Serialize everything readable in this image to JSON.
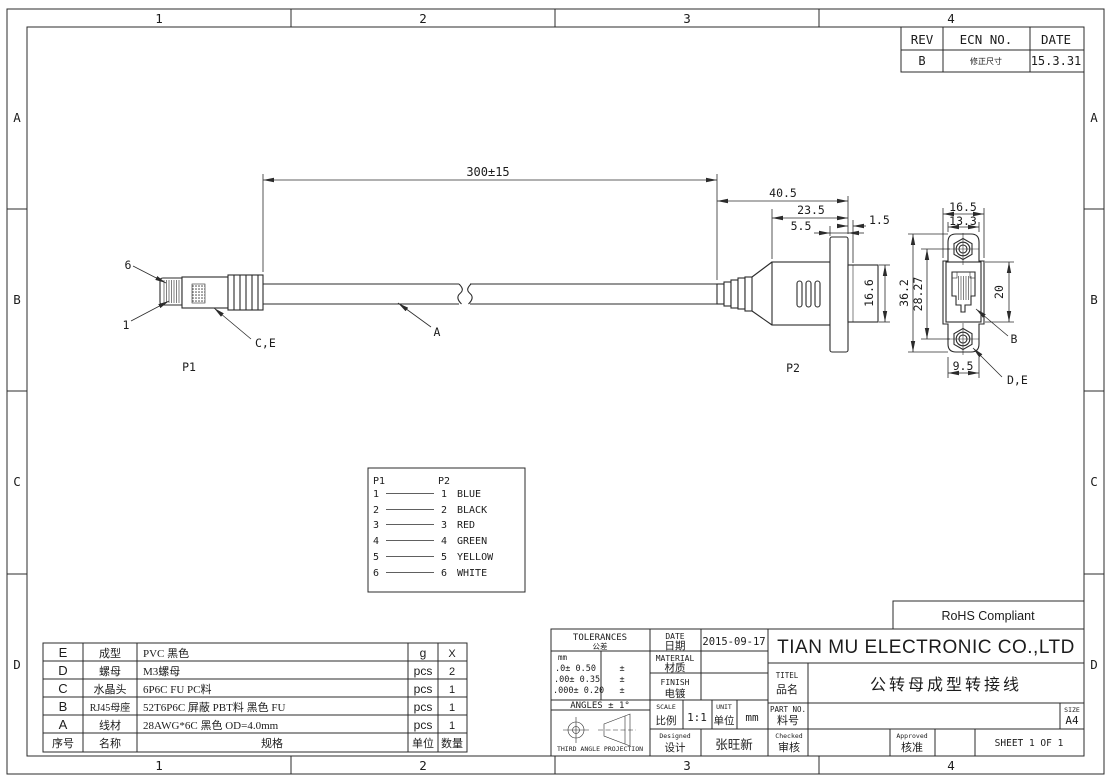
{
  "zones": {
    "cols": [
      "1",
      "2",
      "3",
      "4"
    ],
    "rows": [
      "A",
      "B",
      "C",
      "D"
    ]
  },
  "rev_table": {
    "headers": [
      "REV",
      "ECN NO.",
      "DATE"
    ],
    "row": {
      "rev": "B",
      "ecn": "修正尺寸",
      "date": "15.3.31"
    }
  },
  "drawing": {
    "p1_label": "P1",
    "p2_label": "P2",
    "pin_top": "6",
    "pin_bottom": "1",
    "ref_ce": "C,E",
    "ref_a": "A",
    "ref_b": "B",
    "ref_de": "D,E",
    "dims": {
      "cable_length": "300±15",
      "overall": "40.5",
      "body": "23.5",
      "flange_offset": "5.5",
      "lip": "1.5",
      "jack_height": "16.6",
      "flange_width": "16.5",
      "top_width": "13.3",
      "flange_height": "36.2",
      "hole_spacing": "28.27",
      "front_height": "20",
      "bottom_width": "9.5"
    }
  },
  "wiring": {
    "p1_header": "P1",
    "p2_header": "P2",
    "rows": [
      {
        "p1": "1",
        "p2": "1",
        "color": "BLUE"
      },
      {
        "p1": "2",
        "p2": "2",
        "color": "BLACK"
      },
      {
        "p1": "3",
        "p2": "3",
        "color": "RED"
      },
      {
        "p1": "4",
        "p2": "4",
        "color": "GREEN"
      },
      {
        "p1": "5",
        "p2": "5",
        "color": "YELLOW"
      },
      {
        "p1": "6",
        "p2": "6",
        "color": "WHITE"
      }
    ]
  },
  "bom": {
    "rows": [
      {
        "no": "E",
        "name": "成型",
        "spec": "PVC 黑色",
        "unit": "g",
        "qty": "X"
      },
      {
        "no": "D",
        "name": "螺母",
        "spec": "M3螺母",
        "unit": "pcs",
        "qty": "2"
      },
      {
        "no": "C",
        "name": "水晶头",
        "spec": "6P6C FU PC料",
        "unit": "pcs",
        "qty": "1"
      },
      {
        "no": "B",
        "name": "RJ45母座",
        "spec": "52T6P6C 屏蔽 PBT料 黑色 FU",
        "unit": "pcs",
        "qty": "1"
      },
      {
        "no": "A",
        "name": "线材",
        "spec": "28AWG*6C 黑色 OD=4.0mm",
        "unit": "pcs",
        "qty": "1"
      }
    ],
    "footer": {
      "no": "序号",
      "name": "名称",
      "spec": "规格",
      "unit": "单位",
      "qty": "数量"
    }
  },
  "title_block": {
    "tolerances": {
      "title": "TOLERANCES",
      "title_cn": "公差",
      "mm": "mm",
      "rows": [
        {
          "v": ".0±  0.50",
          "pm": "±"
        },
        {
          "v": ".00±  0.35",
          "pm": "±"
        },
        {
          "v": ".000±  0.20",
          "pm": "±"
        }
      ],
      "angles": "ANGLES   ±   1°",
      "projection": "THIRD ANGLE PROJECTION"
    },
    "date_label": "DATE",
    "date_cn": "日期",
    "date_value": "2015-09-17",
    "material_label": "MATERIAL",
    "material_cn": "材质",
    "material_value": "",
    "finish_label": "FINISH",
    "finish_cn": "电镀",
    "finish_value": "",
    "scale_label": "SCALE",
    "scale_cn": "比例",
    "scale_value": "1:1",
    "unit_label": "UNIT",
    "unit_cn": "单位",
    "unit_value": "mm",
    "designed_label": "Designed",
    "designed_cn": "设计",
    "designed_value": "张旺新",
    "company": "TIAN MU ELECTRONIC CO.,LTD",
    "titel_label": "TITEL",
    "titel_cn": "品名",
    "titel_value": "公转母成型转接线",
    "partno_label": "PART NO.",
    "partno_cn": "料号",
    "partno_value": "",
    "size_label": "SIZE",
    "size_value": "A4",
    "checked_label": "Checked",
    "checked_cn": "审核",
    "checked_value": "",
    "approved_label": "Approved",
    "approved_cn": "核准",
    "approved_value": "",
    "sheet": "SHEET 1 OF 1",
    "rohs": "RoHS Compliant"
  }
}
